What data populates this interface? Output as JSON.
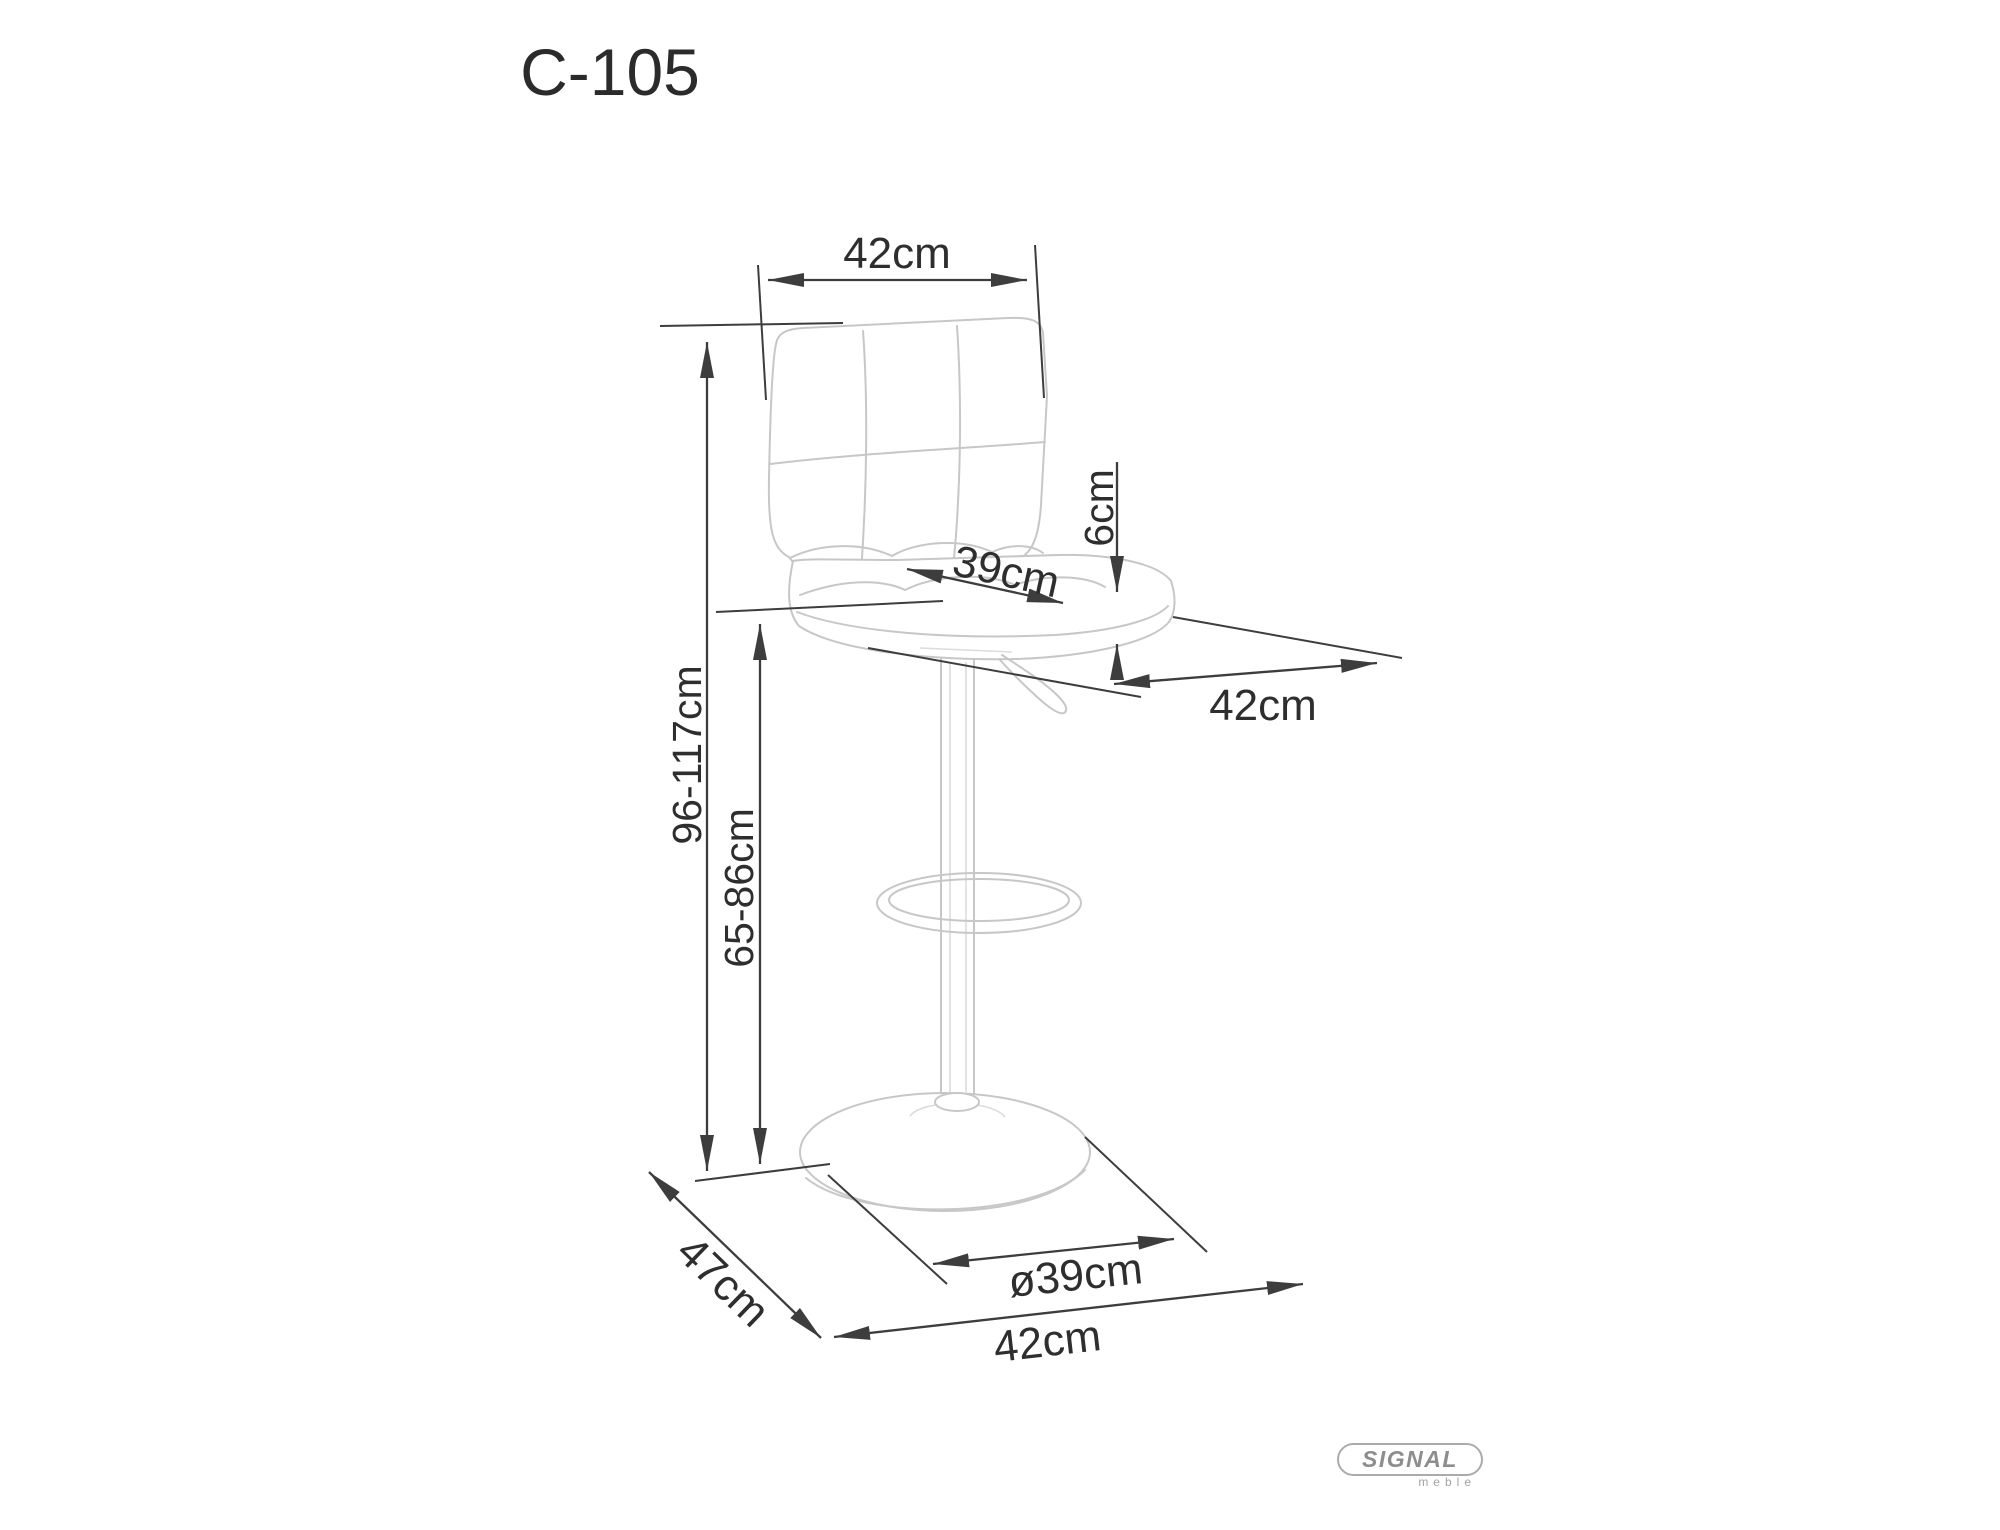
{
  "page": {
    "background": "#ffffff"
  },
  "drawing": {
    "title": "C-105",
    "subject": "bar-stool-technical-drawing",
    "colors": {
      "dimension_lines": "#3d3d3d",
      "furniture_lines": "#c7c7c7",
      "text": "#2e2e2e",
      "logo_gray": "#8d8d8d"
    },
    "dimensions": {
      "backrest_width": "42cm",
      "total_height": "96-117cm",
      "seat_height": "65-86cm",
      "seat_width": "39cm",
      "seat_thickness": "6cm",
      "seat_depth": "42cm",
      "base_diameter": "ø39cm",
      "base_width": "42cm",
      "base_depth": "47cm"
    },
    "logo": {
      "brand": "SIGNAL",
      "sub": "meble"
    }
  }
}
